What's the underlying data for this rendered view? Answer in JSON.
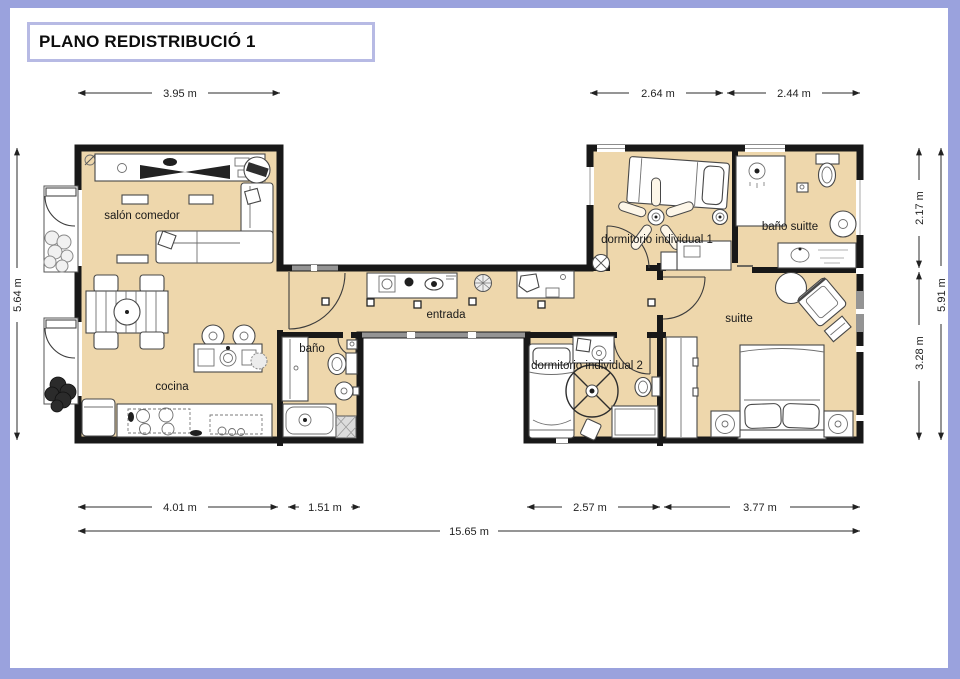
{
  "title": "PLANO REDISTRIBUCIÓ 1",
  "rooms": {
    "salon": "salón comedor",
    "cocina": "cocina",
    "bano": "baño",
    "entrada": "entrada",
    "dorm1": "dormitorio individual 1",
    "bano_suitte": "baño suitte",
    "suitte": "suitte",
    "dorm2": "dormitorio individual 2"
  },
  "dimensions": {
    "top_salon": "3.95 m",
    "top_dorm1": "2.64 m",
    "top_bano_suitte": "2.44 m",
    "left_total": "5.64 m",
    "right_top": "2.17 m",
    "right_bottom": "3.28 m",
    "right_total": "5.91 m",
    "bottom_cocina": "4.01 m",
    "bottom_bano": "1.51 m",
    "bottom_dorm2": "2.57 m",
    "bottom_suitte": "3.77 m",
    "bottom_total": "15.65 m"
  },
  "colors": {
    "frame": "#9aa2dd",
    "title_border": "#b7bae4",
    "room_fill": "#eed7ac",
    "wall": "#181818",
    "window_gray": "#949494"
  }
}
